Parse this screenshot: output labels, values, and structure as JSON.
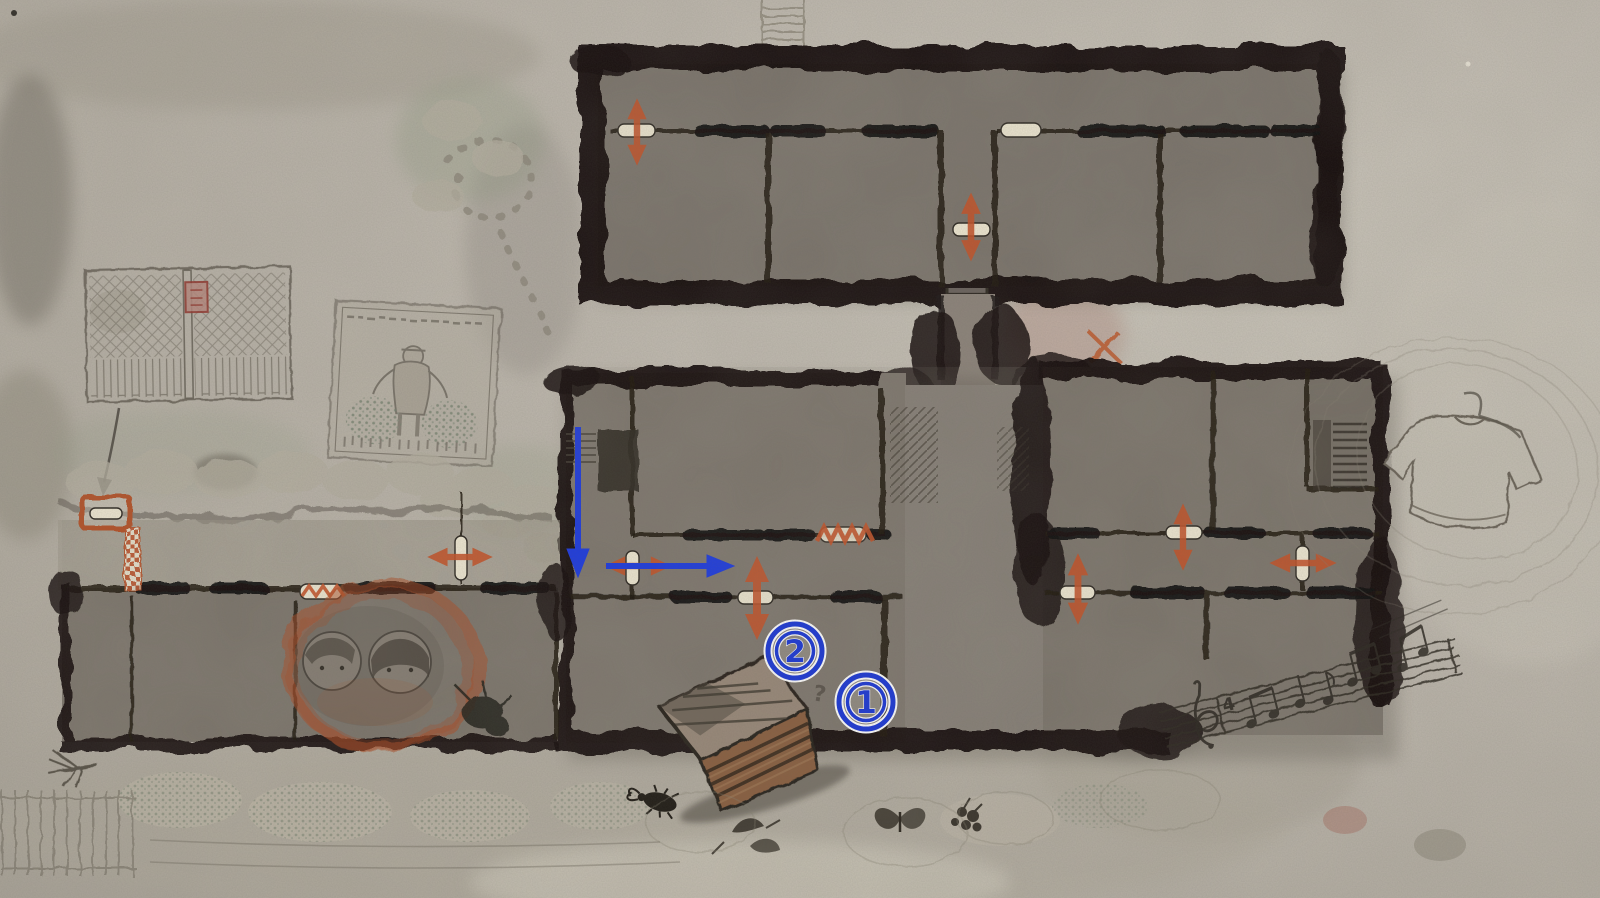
{
  "meta": {
    "app": "game-map",
    "scene": "ink-wash hand-drawn floor plan of a rural compound with marked route"
  },
  "palette": {
    "paper": "#bdb7ab",
    "ink": "#17130e",
    "room_fill": "#7d766d",
    "accent_orange": "#c5542a",
    "route_blue": "#1e3ce0",
    "door_pill": "#efe8d3",
    "red_seal": "#9e3b32"
  },
  "markers": {
    "spots": [
      {
        "label": "2",
        "x": 795,
        "y": 651
      },
      {
        "label": "1",
        "x": 866,
        "y": 702
      }
    ],
    "question": {
      "label": "?",
      "x": 818,
      "y": 690
    },
    "music_time_signature": "4"
  },
  "icons": [
    "orange-door-arrow-vertical",
    "orange-door-arrow-horizontal",
    "blue-route-arrow-down",
    "blue-route-arrow-right",
    "door-pill",
    "blocked-door-zigzag",
    "blocked-door-checker",
    "x-mark",
    "stairs",
    "crate",
    "portraits-circle",
    "t-shirt-sketch",
    "music-staff",
    "farmer-poster",
    "gate-sketch",
    "numbered-spot"
  ]
}
